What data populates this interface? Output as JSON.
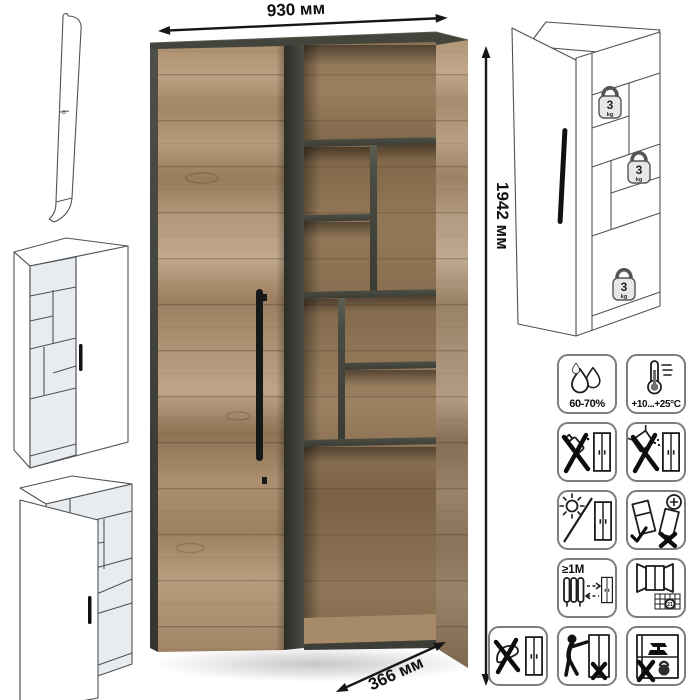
{
  "product": {
    "dimensions": {
      "width": "930 мм",
      "height": "1942 мм",
      "depth": "366 мм"
    },
    "shelf_load": {
      "value": "3",
      "unit": "kg"
    }
  },
  "care": {
    "humidity_label": "60-70%",
    "temperature_label": "+10...+25°C",
    "heat_distance_label": "≥1M",
    "acclimatization_label": "21",
    "icons": [
      "humidity-drops",
      "thermometer",
      "no-solvents",
      "no-abrasives",
      "no-direct-sunlight",
      "tilt-when-moving",
      "keep-1m-from-heat",
      "ventilate-window",
      "no-climbing",
      "no-pushing",
      "no-heavy-items"
    ]
  },
  "colors": {
    "wood": "#ab8f6f",
    "wood_dark": "#8a7156",
    "graphite": "#45463e",
    "line": "#4e5357"
  }
}
